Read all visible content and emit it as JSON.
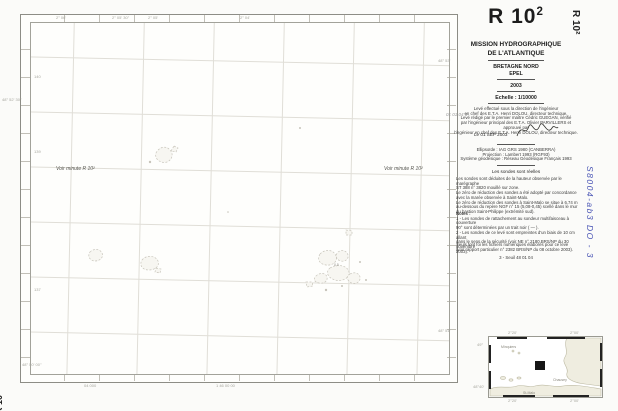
{
  "sheet": {
    "title": "R 10",
    "title_exp": "2",
    "corner_ref": "R 10²",
    "handwritten_ref": "S8004-ab3 DO - 3",
    "pencil_note": "01 01 04 3"
  },
  "map": {
    "see_minute": "Voir minute R 10²",
    "sounding": "0,5",
    "edge": {
      "top": [
        "2° 06'",
        "2° 05' 30''",
        "2° 05'",
        "2° 04'"
      ],
      "left": [
        "140",
        "48° 52' 30''",
        "139",
        "137"
      ],
      "right": [
        "48° 53'",
        "48° 51'"
      ],
      "bottom": [
        "04 000",
        "1 46 00 00"
      ],
      "corner_bl": "48° 50' 00''"
    }
  },
  "panel": {
    "org_line1": "MISSION HYDROGRAPHIQUE",
    "org_line2": "DE L'ATLANTIQUE",
    "region": "BRETAGNE NORD",
    "zone": "EPEL",
    "year": "2003",
    "scale": "Echelle : 1/10000",
    "direction_lines": [
      "Levé effectué sous la direction de l'ingénieur",
      "en chef des E.T.A. Henri DOLOU, directeur technique.",
      "Levé rédigé par le premier maître Cédric GUEGAN, vérifié",
      "par l'ingénieur principal des E.T.A. Olivier PARVILLERS et approuvé par",
      "l'ingénieur en chef des E.T.A. Henri DOLOU, directeur technique."
    ],
    "date_signed": "Le 01 SEP 2003",
    "geodesy_lines": [
      "Ellipsoïde : IAG GRS 1980 (CANBERRA)",
      "Projection : Lambert 1993 (RGF93)",
      "Système géodésique : Réseau Géodésique Français 1993"
    ],
    "soundings_header": "Les sondes sont réelles",
    "soundings_lines": [
      "Les sondes sont déduites de la hauteur observée par le marégraphe",
      "ST 388 n° 3820 mouillé sur zone.",
      "Le zéro de réduction des sondes a été adopté par concordance",
      "avec la marée observée à Saint-Malo.",
      "Le zéro de réduction des sondes à Saint-Malo se situe à 6,74 m",
      "au-dessous du repère NGF n° 15 (5,08-0,45) scellé dans le mur",
      "du bastion Saint-Philippe (extrémité sud)."
    ],
    "notes_label": "Notes :",
    "notes_lines": [
      "1 -  Les sondes de rattachement au sondeur multifaisceau à couverture",
      "90° sont déterminées par un trait noir ( — ).",
      "2 -  Les sondes de ce levé sont empreintes d'un biais de 10 cm allant",
      "dans le sens de la sécurité (voir NE n° 2180 BRS/NP du 30 novembre",
      "2003)."
    ],
    "files_lines": [
      "Seuls font foi les fichiers numériques élaborés pour ce levé",
      "(voir rapport particulier n° 2382 BRS/NP du 08 octobre 2003)."
    ],
    "footer_ref": "3 - Seuil 48 01 04"
  },
  "inset": {
    "labels": {
      "minquiers": "Minquiers",
      "chausey": "Chausey",
      "stmalo": "St-Malo"
    },
    "ticks": {
      "tl": "2°20'",
      "tr": "2°00'",
      "lt": "49°",
      "lb": "48°40'",
      "bl": "2°20'",
      "br": "2°00'"
    }
  }
}
